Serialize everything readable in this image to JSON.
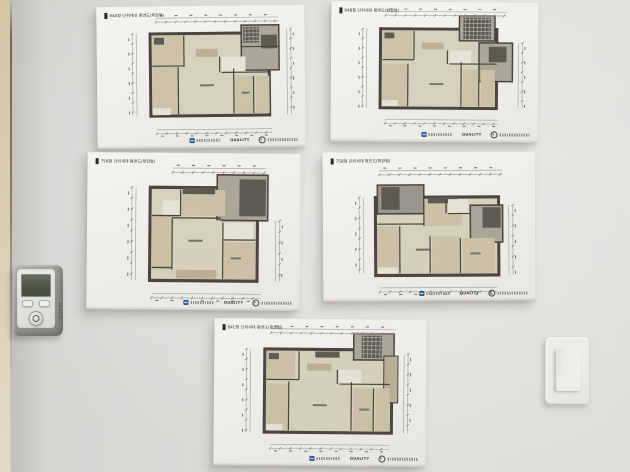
{
  "scene": {
    "description": "Showroom wall with five apartment unit floor-plan presentation boards, a wall-mounted unit controller on the left, and a rocker light switch on the right",
    "wall_color": "#e0dfdc",
    "left_edge_color": "#dccfaf"
  },
  "palette": {
    "wall": "#3e3a34",
    "floor1": "#d9d1bc",
    "floor2": "#cbc1a6",
    "floor3": "#b9ae92",
    "core": "#aaa496",
    "white": "#e9e5d9",
    "furn": "#555048",
    "gray": "#96918a",
    "dimline": "#a9a7a2",
    "speck": "#6f6d68",
    "hatchline": "#cfcabc"
  },
  "board_footer": {
    "builder_logo": "blue-square-logo",
    "quality_text": "QUALITY",
    "cert_logo": "circle-cert-logo"
  },
  "boards": [
    {
      "id": "84a",
      "title": "84A형 단위세대 평면도(확장형)",
      "pos": {
        "left": 97,
        "top": 6,
        "width": 208,
        "height": 142,
        "rotate": -0.6
      },
      "plan": {
        "rects": [
          [
            54,
            28,
            120,
            84,
            "floor1",
            "wall",
            3
          ],
          [
            146,
            20,
            38,
            46,
            "core",
            "wall",
            1.5
          ],
          [
            56,
            30,
            32,
            30,
            "floor2",
            null,
            0
          ],
          [
            90,
            30,
            38,
            32,
            "floor1",
            null,
            0
          ],
          [
            58,
            32,
            10,
            7,
            "furn",
            null,
            0
          ],
          [
            100,
            44,
            22,
            8,
            "floor3",
            null,
            0
          ],
          [
            56,
            62,
            26,
            48,
            "floor2",
            null,
            0
          ],
          [
            84,
            64,
            54,
            46,
            "floor1",
            null,
            0
          ],
          [
            126,
            52,
            24,
            16,
            "white",
            null,
            0
          ],
          [
            138,
            72,
            20,
            38,
            "floor2",
            null,
            0
          ],
          [
            160,
            72,
            14,
            38,
            "floor2",
            null,
            0
          ],
          [
            56,
            104,
            18,
            7,
            "white",
            null,
            0
          ],
          [
            166,
            30,
            16,
            14,
            "furn",
            null,
            0
          ],
          [
            104,
            80,
            14,
            2,
            "speck",
            null,
            0
          ],
          [
            146,
            88,
            8,
            2,
            "speck",
            null,
            0
          ]
        ],
        "lines": [
          [
            88,
            30,
            88,
            62
          ],
          [
            56,
            61,
            88,
            61
          ],
          [
            82,
            62,
            82,
            110
          ],
          [
            138,
            64,
            138,
            110
          ],
          [
            158,
            72,
            158,
            110
          ],
          [
            124,
            52,
            124,
            68
          ],
          [
            126,
            68,
            174,
            68
          ],
          [
            146,
            42,
            184,
            42
          ]
        ],
        "hatch": [
          [
            148,
            22,
            16,
            16
          ]
        ],
        "dims": {
          "top": [
            60,
            184,
            12
          ],
          "bottom": [
            60,
            176,
            126
          ],
          "left": [
            40,
            28,
            112
          ],
          "right": [
            192,
            24,
            112
          ]
        }
      }
    },
    {
      "id": "84b",
      "title": "84B형 단위세대 평면도(확장형)",
      "pos": {
        "left": 331,
        "top": 2,
        "width": 207,
        "height": 140,
        "rotate": 0.4
      },
      "plan": {
        "rects": [
          [
            50,
            28,
            118,
            82,
            "floor1",
            "wall",
            3
          ],
          [
            130,
            14,
            36,
            26,
            "core",
            "wall",
            1.5
          ],
          [
            150,
            42,
            34,
            40,
            "core",
            "wall",
            1.5
          ],
          [
            52,
            30,
            30,
            30,
            "floor2",
            null,
            0
          ],
          [
            84,
            30,
            40,
            30,
            "floor1",
            null,
            0
          ],
          [
            54,
            32,
            10,
            6,
            "furn",
            null,
            0
          ],
          [
            92,
            42,
            22,
            7,
            "floor3",
            null,
            0
          ],
          [
            52,
            64,
            26,
            44,
            "floor2",
            null,
            0
          ],
          [
            80,
            64,
            52,
            44,
            "floor1",
            null,
            0
          ],
          [
            120,
            50,
            22,
            14,
            "white",
            null,
            0
          ],
          [
            134,
            70,
            16,
            38,
            "floor2",
            null,
            0
          ],
          [
            152,
            70,
            14,
            38,
            "floor2",
            null,
            0
          ],
          [
            52,
            102,
            16,
            6,
            "white",
            null,
            0
          ],
          [
            160,
            46,
            18,
            16,
            "furn",
            null,
            0
          ],
          [
            100,
            84,
            14,
            2,
            "speck",
            null,
            0
          ]
        ],
        "lines": [
          [
            84,
            30,
            84,
            60
          ],
          [
            52,
            60,
            84,
            60
          ],
          [
            78,
            64,
            78,
            108
          ],
          [
            132,
            62,
            132,
            108
          ],
          [
            150,
            70,
            150,
            108
          ],
          [
            118,
            50,
            118,
            64
          ],
          [
            120,
            64,
            168,
            64
          ]
        ],
        "hatch": [
          [
            134,
            16,
            28,
            22
          ]
        ],
        "dims": {
          "top": [
            55,
            178,
            10
          ],
          "bottom": [
            55,
            170,
            122
          ],
          "left": [
            36,
            28,
            110
          ],
          "right": [
            190,
            42,
            110
          ]
        }
      }
    },
    {
      "id": "75a",
      "title": "75A형 단위세대 평면도(확장형)",
      "pos": {
        "left": 87,
        "top": 153,
        "width": 213,
        "height": 157,
        "rotate": 0.5
      },
      "plan": {
        "rects": [
          [
            62,
            32,
            106,
            86,
            "floor1",
            "wall",
            3
          ],
          [
            128,
            20,
            50,
            42,
            "core",
            "wall",
            1.5
          ],
          [
            150,
            24,
            26,
            34,
            "furn",
            null,
            0
          ],
          [
            92,
            34,
            44,
            24,
            "floor2",
            null,
            0
          ],
          [
            94,
            32,
            32,
            6,
            "furn",
            null,
            0
          ],
          [
            74,
            44,
            18,
            16,
            "white",
            null,
            0
          ],
          [
            64,
            58,
            20,
            50,
            "floor2",
            null,
            0
          ],
          [
            84,
            62,
            48,
            42,
            "floor1",
            null,
            0
          ],
          [
            134,
            64,
            30,
            16,
            "white",
            null,
            0
          ],
          [
            134,
            82,
            32,
            34,
            "floor2",
            null,
            0
          ],
          [
            88,
            108,
            40,
            8,
            "floor3",
            null,
            0
          ],
          [
            100,
            80,
            14,
            2,
            "speck",
            null,
            0
          ],
          [
            142,
            96,
            10,
            2,
            "speck",
            null,
            0
          ]
        ],
        "lines": [
          [
            92,
            34,
            92,
            58
          ],
          [
            64,
            58,
            92,
            58
          ],
          [
            84,
            60,
            132,
            60
          ],
          [
            84,
            60,
            84,
            108
          ],
          [
            134,
            80,
            166,
            80
          ],
          [
            134,
            64,
            134,
            116
          ],
          [
            64,
            106,
            84,
            106
          ]
        ],
        "hatch": [],
        "dims": {
          "top": [
            84,
            176,
            14
          ],
          "bottom": [
            64,
            172,
            130
          ],
          "left": [
            48,
            32,
            118
          ],
          "right": [
            186,
            62,
            118
          ]
        }
      }
    },
    {
      "id": "75b",
      "title": "75B형 단위세대 평면도(확장형)",
      "pos": {
        "left": 323,
        "top": 152,
        "width": 212,
        "height": 149,
        "rotate": -0.3
      },
      "plan": {
        "rects": [
          [
            52,
            44,
            122,
            76,
            "floor1",
            "wall",
            3
          ],
          [
            54,
            32,
            46,
            28,
            "gray",
            "wall",
            1.5
          ],
          [
            58,
            34,
            18,
            22,
            "furn",
            null,
            0
          ],
          [
            100,
            46,
            38,
            26,
            "floor2",
            null,
            0
          ],
          [
            104,
            44,
            30,
            6,
            "furn",
            null,
            0
          ],
          [
            146,
            52,
            32,
            36,
            "core",
            "wall",
            1.5
          ],
          [
            158,
            54,
            18,
            20,
            "furn",
            null,
            0
          ],
          [
            124,
            46,
            20,
            14,
            "white",
            null,
            0
          ],
          [
            54,
            72,
            22,
            46,
            "floor2",
            null,
            0
          ],
          [
            78,
            72,
            58,
            46,
            "floor1",
            null,
            0
          ],
          [
            108,
            82,
            28,
            36,
            "floor2",
            null,
            0
          ],
          [
            138,
            84,
            32,
            34,
            "floor2",
            null,
            0
          ],
          [
            54,
            112,
            20,
            6,
            "white",
            null,
            0
          ],
          [
            92,
            94,
            14,
            2,
            "speck",
            null,
            0
          ],
          [
            146,
            98,
            10,
            2,
            "speck",
            null,
            0
          ]
        ],
        "lines": [
          [
            100,
            46,
            100,
            72
          ],
          [
            54,
            70,
            100,
            70
          ],
          [
            76,
            72,
            76,
            118
          ],
          [
            106,
            82,
            106,
            118
          ],
          [
            136,
            84,
            136,
            118
          ],
          [
            122,
            46,
            122,
            60
          ],
          [
            124,
            60,
            146,
            60
          ]
        ],
        "hatch": [],
        "dims": {
          "top": [
            56,
            178,
            18
          ],
          "bottom": [
            56,
            172,
            132
          ],
          "left": [
            40,
            44,
            118
          ],
          "right": [
            184,
            52,
            120
          ]
        }
      }
    },
    {
      "id": "84c",
      "title": "84C형 단위세대 평면도(확장형)",
      "pos": {
        "left": 214,
        "top": 319,
        "width": 212,
        "height": 147,
        "rotate": 0.5
      },
      "plan": {
        "rects": [
          [
            50,
            30,
            126,
            82,
            "floor1",
            "wall",
            3
          ],
          [
            138,
            14,
            40,
            26,
            "core",
            "wall",
            1.5
          ],
          [
            168,
            36,
            14,
            46,
            "floor3",
            "wall",
            1
          ],
          [
            52,
            32,
            28,
            28,
            "floor2",
            null,
            0
          ],
          [
            54,
            34,
            10,
            6,
            "furn",
            null,
            0
          ],
          [
            84,
            32,
            40,
            28,
            "floor1",
            null,
            0
          ],
          [
            100,
            32,
            24,
            6,
            "furn",
            null,
            0
          ],
          [
            92,
            44,
            24,
            7,
            "floor3",
            null,
            0
          ],
          [
            52,
            64,
            22,
            46,
            "floor2",
            null,
            0
          ],
          [
            76,
            62,
            60,
            48,
            "floor1",
            null,
            0
          ],
          [
            124,
            50,
            22,
            14,
            "white",
            null,
            0
          ],
          [
            138,
            68,
            20,
            42,
            "floor2",
            null,
            0
          ],
          [
            160,
            68,
            14,
            42,
            "floor2",
            null,
            0
          ],
          [
            52,
            104,
            16,
            6,
            "white",
            null,
            0
          ],
          [
            98,
            84,
            14,
            2,
            "speck",
            null,
            0
          ],
          [
            144,
            88,
            10,
            2,
            "speck",
            null,
            0
          ]
        ],
        "lines": [
          [
            84,
            32,
            84,
            60
          ],
          [
            52,
            60,
            84,
            60
          ],
          [
            74,
            62,
            74,
            110
          ],
          [
            136,
            62,
            136,
            110
          ],
          [
            158,
            68,
            158,
            110
          ],
          [
            122,
            50,
            122,
            64
          ],
          [
            124,
            64,
            174,
            64
          ]
        ],
        "hatch": [
          [
            146,
            16,
            20,
            22
          ]
        ],
        "dims": {
          "top": [
            56,
            180,
            10
          ],
          "bottom": [
            56,
            174,
            124
          ],
          "left": [
            36,
            30,
            112
          ],
          "right": [
            188,
            34,
            112
          ]
        }
      }
    }
  ],
  "devices": {
    "thermostat": {
      "name": "wall-mounted unit controller with LCD, two buttons and round dial",
      "screen_color": "#434b3b",
      "body_color": "#8e8e8b"
    },
    "light_switch": {
      "name": "single rocker light switch",
      "plate_color": "#f1f0ee"
    }
  }
}
